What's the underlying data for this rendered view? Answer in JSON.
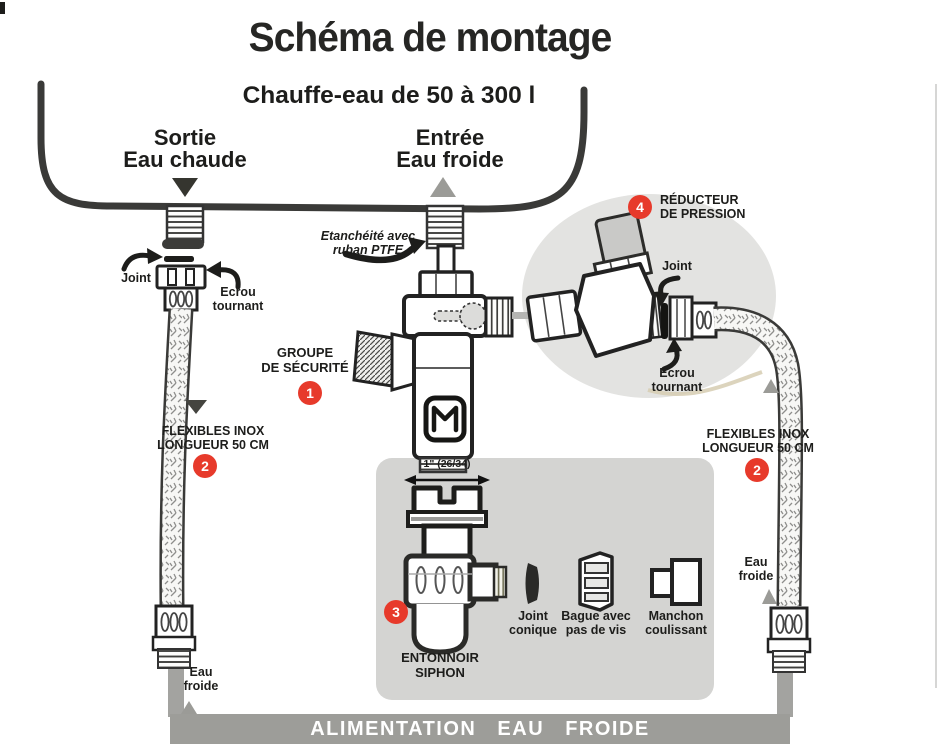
{
  "title": "Schéma de montage",
  "tank": {
    "label": "Chauffe-eau de 50 à 300 l",
    "hot_outlet": "Sortie\nEau chaude",
    "cold_inlet": "Entrée\nEau froide"
  },
  "left": {
    "joint_label": "Joint",
    "ecrou_label": "Ecrou\ntournant",
    "flexibles_label": "FLEXIBLES INOX\nLONGUEUR 50 CM",
    "flexibles_badge": "2",
    "eau_froide_label": "Eau\nfroide"
  },
  "center": {
    "ptfe_note": "Etanchéité avec\nruban PTFE",
    "groupe_label": "GROUPE\nDE SÉCURITÉ",
    "groupe_badge": "1",
    "dimension_label": "1\" (26/34)",
    "entonnoir_label": "ENTONNOIR\nSIPHON",
    "entonnoir_badge": "3",
    "joint_conique_label": "Joint\nconique",
    "bague_label": "Bague avec\npas de vis",
    "manchon_label": "Manchon\ncoulissant"
  },
  "right": {
    "reducteur_label": "RÉDUCTEUR\nDE PRESSION",
    "reducteur_badge": "4",
    "joint_label": "Joint",
    "ecrou_label": "Ecrou\ntournant",
    "flexibles_label": "FLEXIBLES INOX\nLONGUEUR 50 CM",
    "flexibles_badge": "2",
    "eau_froide_label": "Eau\nfroide"
  },
  "footer": {
    "bar_label": "ALIMENTATION EAU FROIDE"
  },
  "colors": {
    "badge_red": "#e73a2b",
    "circle_gray": "#e3e3e1",
    "panel_gray": "#d4d4d2",
    "bar_gray": "#9d9d99",
    "ink": "#2c2c2a"
  }
}
